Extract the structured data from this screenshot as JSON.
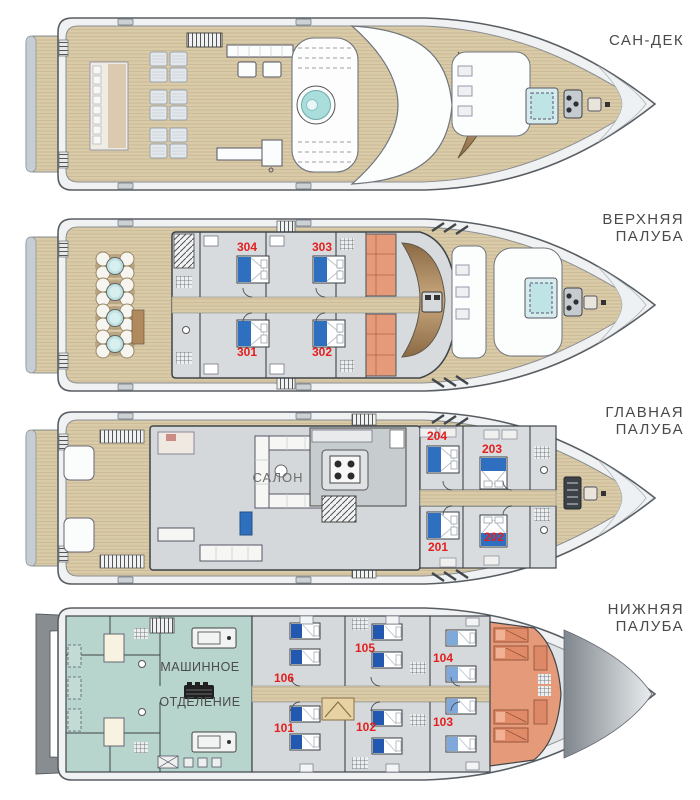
{
  "plan": {
    "decks": [
      {
        "id": "sun-deck",
        "label_line1": "САН-ДЕК",
        "label_line2": ""
      },
      {
        "id": "upper-deck",
        "label_line1": "ВЕРХНЯЯ",
        "label_line2": "ПАЛУБА",
        "cabins": [
          "304",
          "303",
          "301",
          "302"
        ]
      },
      {
        "id": "main-deck",
        "label_line1": "ГЛАВНАЯ",
        "label_line2": "ПАЛУБА",
        "cabins": [
          "204",
          "203",
          "201",
          "202"
        ],
        "salon_label": "САЛОН"
      },
      {
        "id": "lower-deck",
        "label_line1": "НИЖНЯЯ",
        "label_line2": "ПАЛУБА",
        "cabins": [
          "106",
          "105",
          "104",
          "103",
          "102",
          "101"
        ],
        "engine_room_line1": "МАШИННОЕ",
        "engine_room_line2": "ОТДЕЛЕНИЕ"
      }
    ],
    "colors": {
      "cabin_number_red": "#e41e1e",
      "deck_label_grey": "#4a4a4a",
      "guest_bed_blue": "#2e6fc0",
      "twin_bed_light_blue": "#7fa9db",
      "crew_area_salmon": "#e59a79",
      "engine_room_teal": "#b7d4cd",
      "jacuzzi_teal": "#a9dedd",
      "deck_wood_tan": "#d9caa8"
    }
  }
}
